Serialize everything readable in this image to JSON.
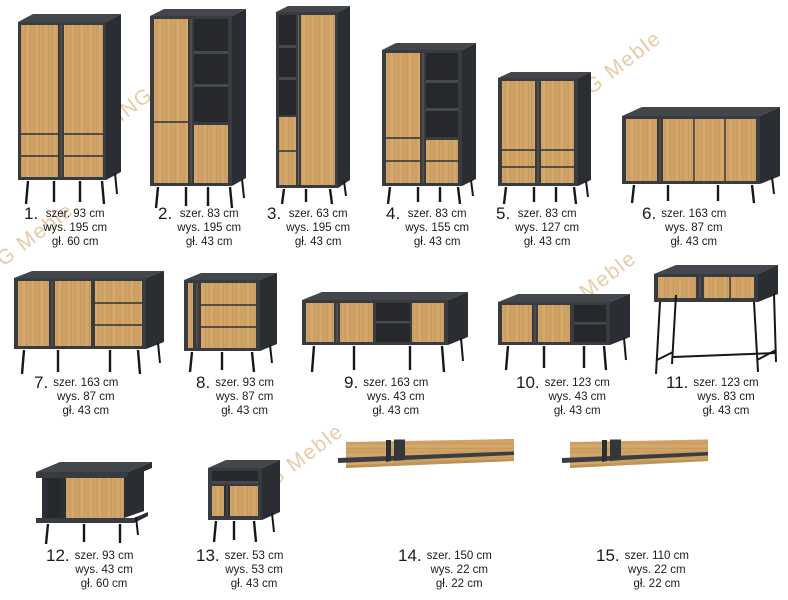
{
  "page": {
    "background": "#ffffff"
  },
  "watermark": {
    "text": "KING Meble",
    "color": "#e0bf92"
  },
  "colors": {
    "oak": "#d0a366",
    "frame_dark": "#383b40",
    "side_dark": "#2a2d31",
    "top_dark": "#43474c",
    "legs": "#15171a",
    "text": "#1b1b1b"
  },
  "items": [
    {
      "number": "1.",
      "kind": "wardrobe-2-door",
      "width": "szer. 93 cm",
      "height": "wys. 195 cm",
      "depth": "gł. 60 cm"
    },
    {
      "number": "2.",
      "kind": "bookcase-display",
      "width": "szer. 83 cm",
      "height": "wys. 195 cm",
      "depth": "gł. 43 cm"
    },
    {
      "number": "3.",
      "kind": "bookcase-narrow",
      "width": "szer. 63 cm",
      "height": "wys. 195 cm",
      "depth": "gł. 43 cm"
    },
    {
      "number": "4.",
      "kind": "highboard-shelves",
      "width": "szer. 83 cm",
      "height": "wys. 155 cm",
      "depth": "gł. 43 cm"
    },
    {
      "number": "5.",
      "kind": "highboard-2-door",
      "width": "szer. 83 cm",
      "height": "wys. 127 cm",
      "depth": "gł. 43 cm"
    },
    {
      "number": "6.",
      "kind": "sideboard-large",
      "width": "szer. 163 cm",
      "height": "wys. 87 cm",
      "depth": "gł. 43 cm"
    },
    {
      "number": "7.",
      "kind": "sideboard-doors-drawers",
      "width": "szer. 163 cm",
      "height": "wys. 87 cm",
      "depth": "gł. 43 cm"
    },
    {
      "number": "8.",
      "kind": "chest-of-drawers",
      "width": "szer. 93 cm",
      "height": "wys. 87 cm",
      "depth": "gł. 43 cm"
    },
    {
      "number": "9.",
      "kind": "tv-stand-large",
      "width": "szer. 163 cm",
      "height": "wys. 43 cm",
      "depth": "gł. 43 cm"
    },
    {
      "number": "10.",
      "kind": "tv-stand-small",
      "width": "szer. 123 cm",
      "height": "wys. 43 cm",
      "depth": "gł. 43 cm"
    },
    {
      "number": "11.",
      "kind": "console-table",
      "width": "szer. 123 cm",
      "height": "wys. 83 cm",
      "depth": "gł. 43 cm"
    },
    {
      "number": "12.",
      "kind": "coffee-table",
      "width": "szer. 93 cm",
      "height": "wys. 43 cm",
      "depth": "gł. 60 cm"
    },
    {
      "number": "13.",
      "kind": "bedside-cabinet",
      "width": "szer. 53 cm",
      "height": "wys. 53 cm",
      "depth": "gł. 43 cm"
    },
    {
      "number": "14.",
      "kind": "wall-shelf",
      "width": "szer. 150 cm",
      "height": "wys. 22 cm",
      "depth": "gł. 22 cm"
    },
    {
      "number": "15.",
      "kind": "wall-shelf",
      "width": "szer. 110 cm",
      "height": "wys. 22 cm",
      "depth": "gł. 22 cm"
    }
  ]
}
